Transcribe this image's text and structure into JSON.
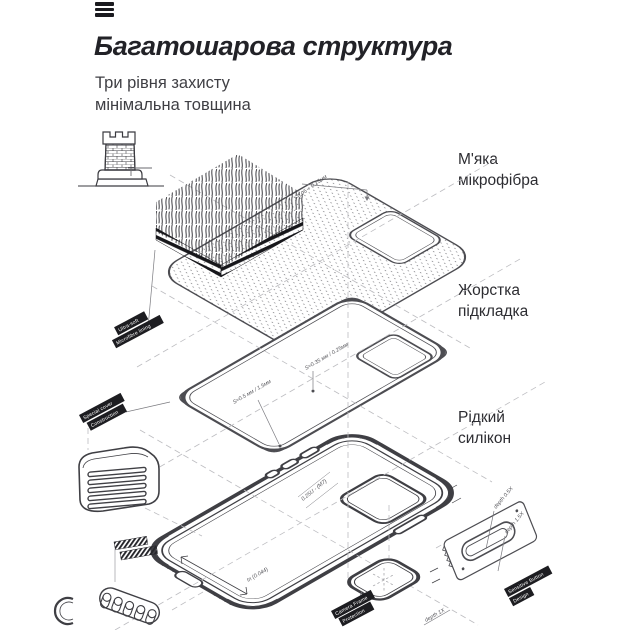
{
  "page": {
    "background": "#ffffff"
  },
  "header": {
    "title": "Багатошарова структура",
    "subtitle": "Три рівня захисту\nмінімальна товщина"
  },
  "callouts": {
    "layer1": "М'яка\nмікрофібра",
    "layer2": "Жорстка\nпідкладка",
    "layer3": "Рідкий\nсилікон"
  },
  "diagram": {
    "icons": {
      "menu": "hamburger-menu-icon",
      "tower": "castle-tower-icon"
    },
    "ribbons": {
      "microfiber": {
        "line1": "Ultra-soft",
        "line2": "Microfibre lining"
      },
      "cover": {
        "line1": "Special cover",
        "line2": "Construction"
      },
      "camera": {
        "line1": "Camera Frame",
        "line2": "Protection"
      },
      "button": {
        "line1": "Sensitive Button",
        "line2": "Design"
      }
    },
    "annotations": {
      "microfiber_thickness": "t-0.05 + 0.15мм",
      "plate_left": "S≈0.5 мм / 1.5мм",
      "plate_right": "S≈0.35 мм / 0.25мм",
      "case_buttons": "0.25U - (М7)",
      "case_inner": "In (0.044)",
      "depth_a": "depth 0.5X",
      "depth_b": "depth 1.5X",
      "depth_c": "depth 1X"
    }
  },
  "colors": {
    "ink": "#232328",
    "line": "#4d4d52",
    "case_line": "#3f3f44",
    "dash": "#bdbdc1",
    "label_bg": "#1d1d21"
  }
}
